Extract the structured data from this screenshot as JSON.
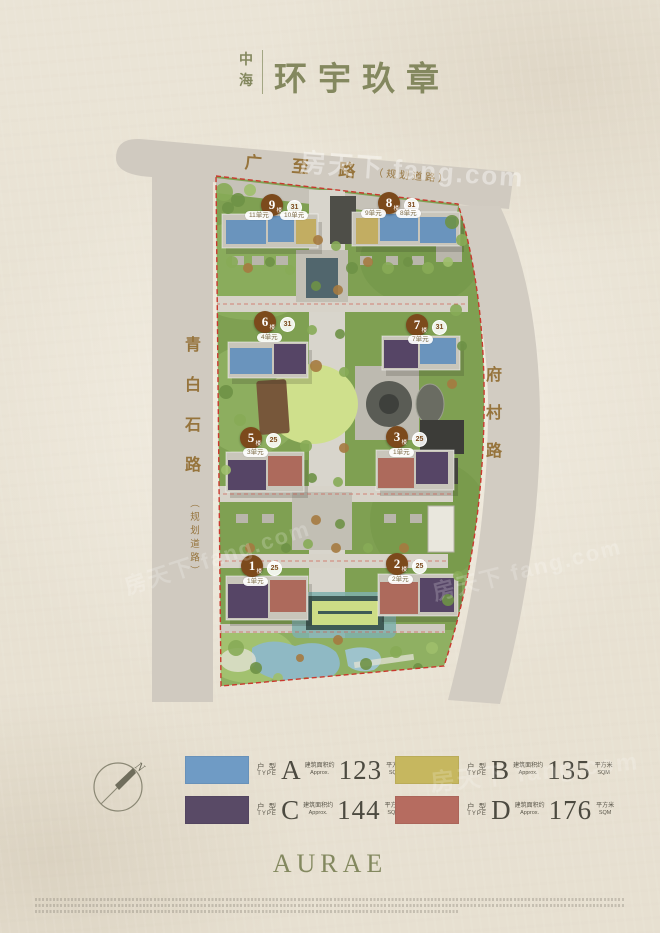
{
  "title": {
    "brand": "中海",
    "name": "环宇玖章"
  },
  "map": {
    "roads": {
      "top": "广至路",
      "top_note": "（规划道路）",
      "left": "青白石路",
      "left_note": "（规划道路）",
      "right": "府村路"
    },
    "boundary_color": "#c9392e",
    "buildings": [
      {
        "label": "9",
        "suffix": "楼",
        "floors": "31",
        "units": [
          "11单元",
          "10单元"
        ]
      },
      {
        "label": "8",
        "suffix": "楼",
        "floors": "31",
        "units": [
          "9单元",
          "8单元"
        ]
      },
      {
        "label": "6",
        "suffix": "楼",
        "floors": "31",
        "units": [
          "4单元"
        ]
      },
      {
        "label": "7",
        "suffix": "楼",
        "floors": "31",
        "units": [
          "7单元"
        ]
      },
      {
        "label": "5",
        "suffix": "楼",
        "floors": "25",
        "units": [
          "3单元"
        ]
      },
      {
        "label": "3",
        "suffix": "楼",
        "floors": "25",
        "units": [
          "1单元"
        ]
      },
      {
        "label": "1",
        "suffix": "楼",
        "floors": "25",
        "units": [
          "1单元"
        ]
      },
      {
        "label": "2",
        "suffix": "楼",
        "floors": "25",
        "units": [
          "2单元"
        ]
      }
    ]
  },
  "legend": {
    "type_cn": "户 型",
    "type_en": "TYPE",
    "approx_cn": "建筑面积约",
    "approx_en": "Approx.",
    "unit_cn": "平方米",
    "unit_en": "SQM",
    "items": [
      {
        "letter": "A",
        "value": "123",
        "color": "#6f9bc5"
      },
      {
        "letter": "B",
        "value": "135",
        "color": "#c6b75f"
      },
      {
        "letter": "C",
        "value": "144",
        "color": "#594a66"
      },
      {
        "letter": "D",
        "value": "176",
        "color": "#b66c60"
      }
    ]
  },
  "compass": {
    "label": "N"
  },
  "logo": "AURAE",
  "watermark": "房天下 fang.com"
}
